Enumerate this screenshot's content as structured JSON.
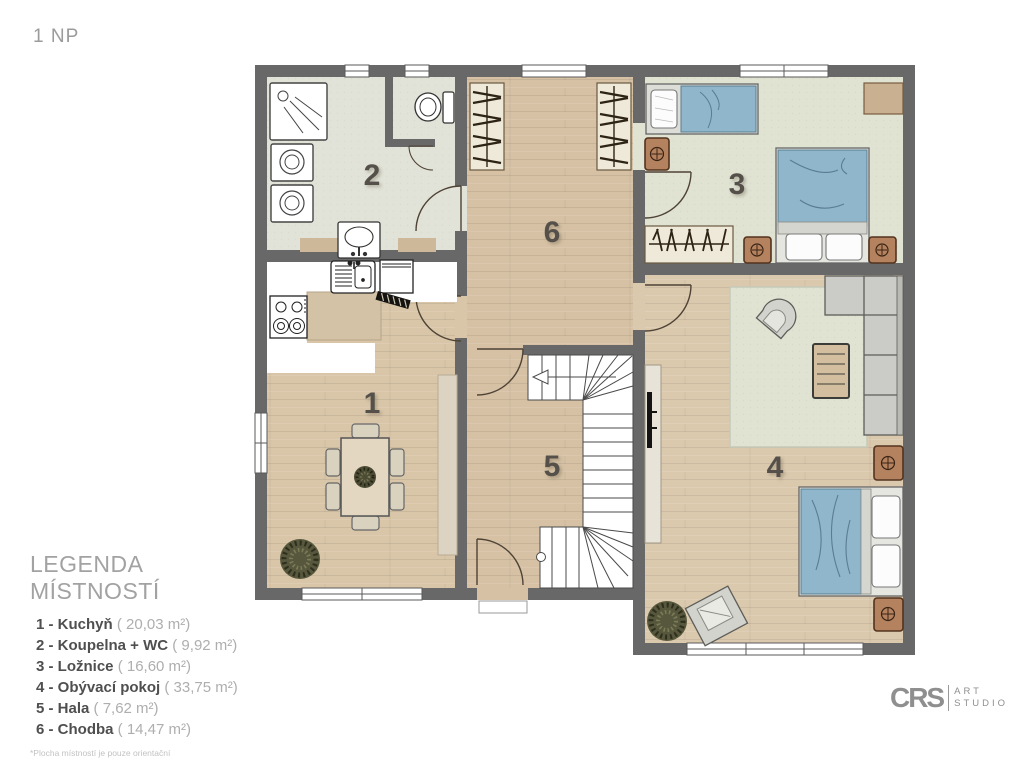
{
  "page": {
    "title": "1 NP"
  },
  "legend": {
    "title": "LEGENDA MÍSTNOSTÍ",
    "items": [
      {
        "num": "1",
        "label": "1 - Kuchyň",
        "area": "( 20,03 m²)"
      },
      {
        "num": "2",
        "label": "2 - Koupelna + WC",
        "area": "( 9,92 m²)"
      },
      {
        "num": "3",
        "label": "3 - Ložnice",
        "area": "( 16,60 m²)"
      },
      {
        "num": "4",
        "label": "4 - Obývací pokoj",
        "area": "( 33,75 m²)"
      },
      {
        "num": "5",
        "label": "5 - Hala",
        "area": "( 7,62 m²)"
      },
      {
        "num": "6",
        "label": "6 - Chodba",
        "area": "( 14,47 m²)"
      }
    ],
    "footnote": "*Plocha místností je pouze orientační"
  },
  "logo": {
    "brand": "CRS",
    "line1": "ART",
    "line2": "STUDIO"
  },
  "rooms": [
    {
      "num": "1",
      "name": "Kuchyň"
    },
    {
      "num": "2",
      "name": "Koupelna + WC"
    },
    {
      "num": "3",
      "name": "Ložnice"
    },
    {
      "num": "4",
      "name": "Obývací pokoj"
    },
    {
      "num": "5",
      "name": "Hala"
    },
    {
      "num": "6",
      "name": "Chodba"
    }
  ],
  "colors": {
    "wall": "#686868",
    "wood": "#d6c1a4",
    "wood_light": "#dbc9ae",
    "wood_kitchen": "#d9c6a9",
    "tile": "#e2e3d8",
    "carpet": "#e0e3d2",
    "rug": "#e0e3d2",
    "bed_blue": "#8fb6ca",
    "furniture_brown": "#b5825f",
    "sofa_gray": "#cbccc7",
    "counter_white": "#ffffff",
    "title_gray": "#9b9b9b",
    "legend_bold": "#4f4f4f",
    "legend_light": "#aeaeae"
  }
}
